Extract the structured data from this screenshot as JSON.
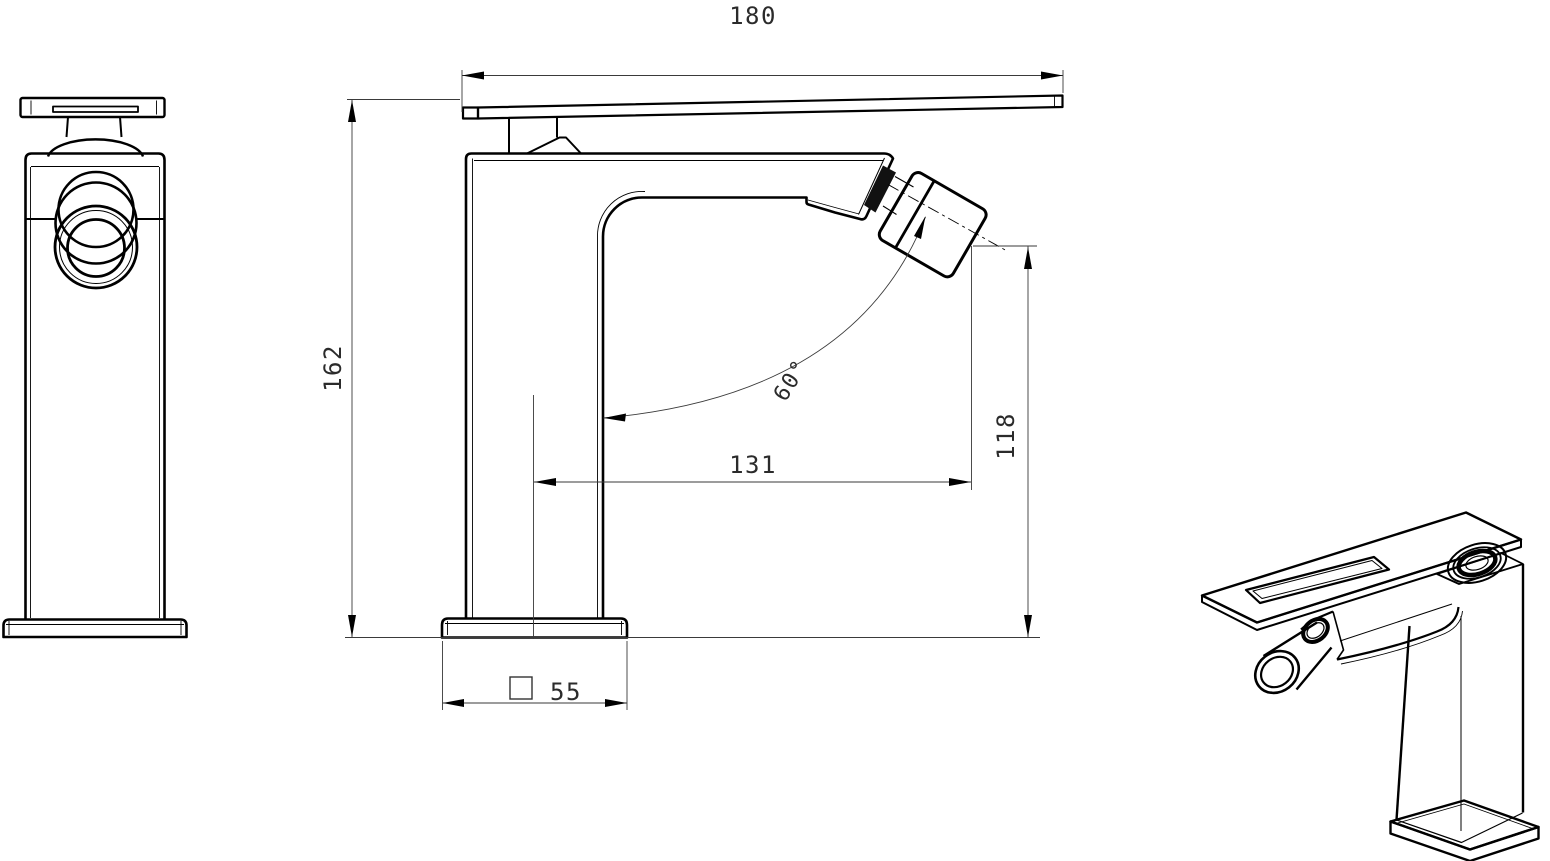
{
  "colors": {
    "background": "#ffffff",
    "line": "#000000",
    "dimension_line": "#3a3a3a",
    "text": "#2b2b2b"
  },
  "dimensions": {
    "overall_width": "180",
    "overall_height": "162",
    "spout_reach": "131",
    "spout_height": "118",
    "spout_angle": "60°",
    "base_size": "55",
    "base_square_symbol": "□"
  }
}
